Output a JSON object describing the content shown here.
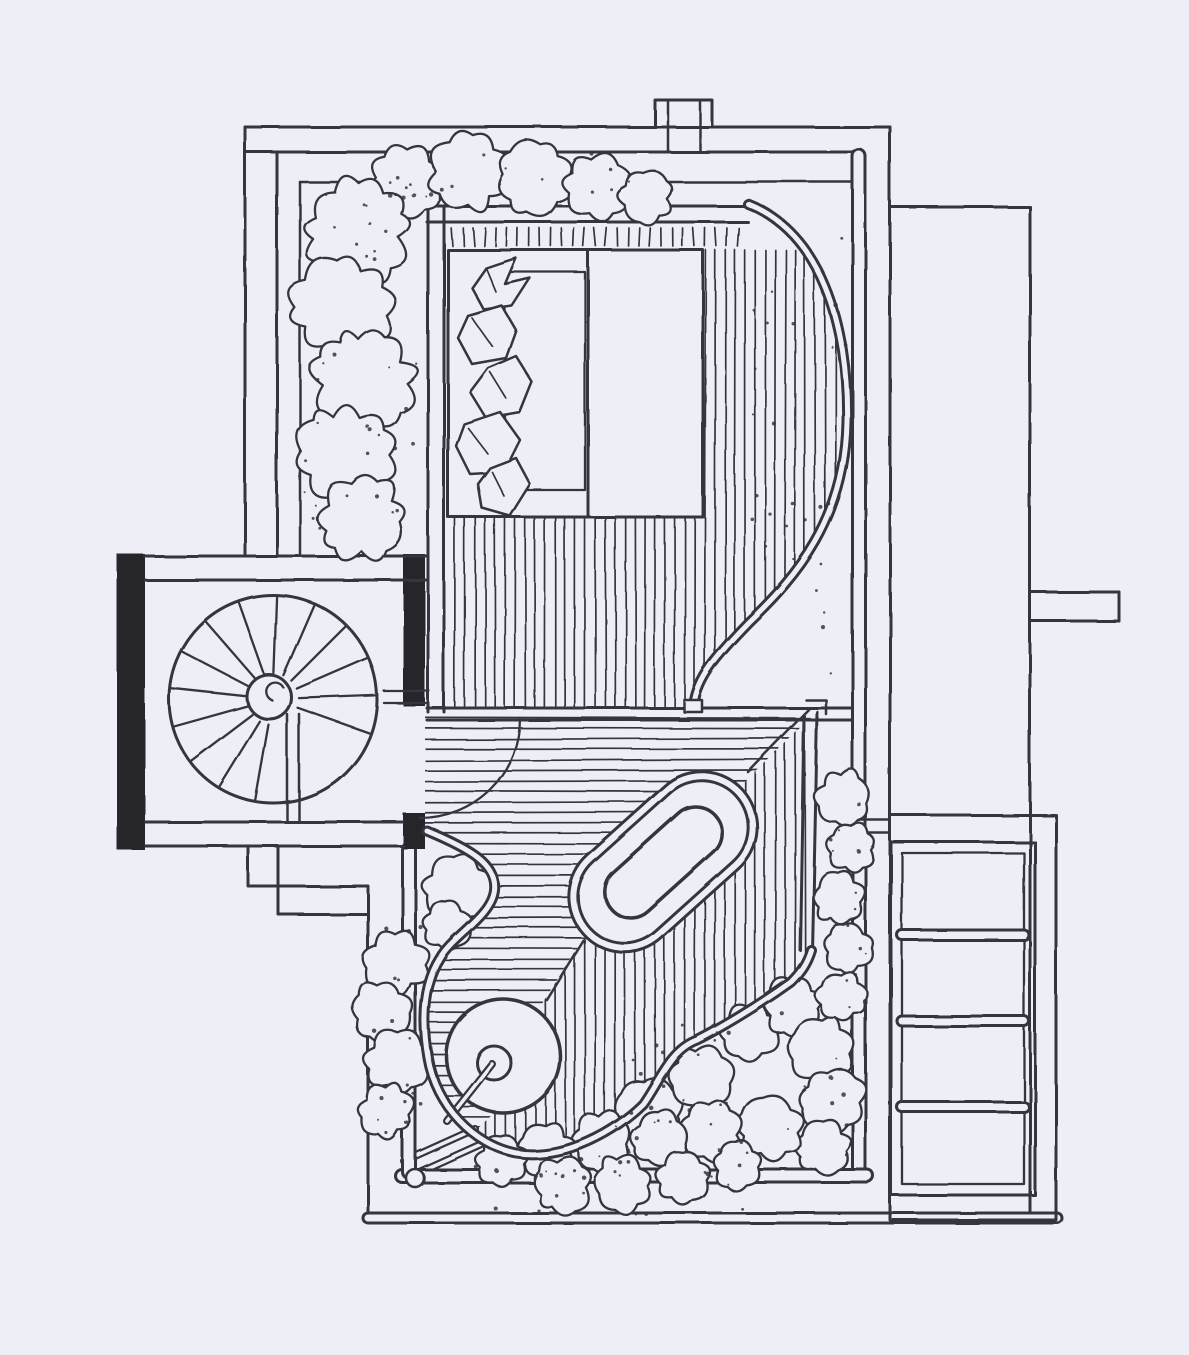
{
  "drawing": {
    "colors": {
      "paper": "#edeef6",
      "ink": "#343640",
      "wall_fill": "#25262c"
    }
  }
}
